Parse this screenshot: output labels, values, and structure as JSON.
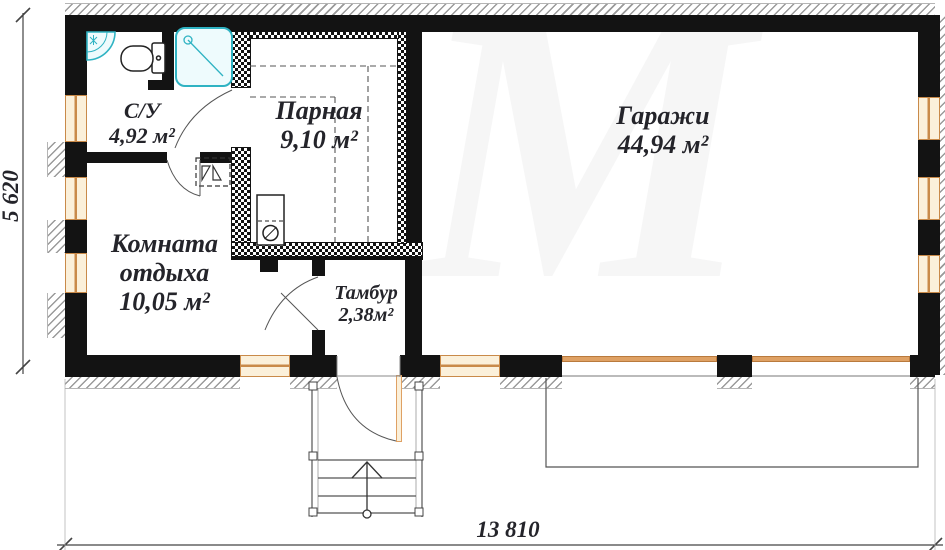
{
  "plan": {
    "title": "Floor plan of sauna with garage",
    "rooms": [
      {
        "id": "su",
        "name": "С/У",
        "area": "4,92 м²"
      },
      {
        "id": "parnaya",
        "name": "Парная",
        "area": "9,10 м²"
      },
      {
        "id": "garazhi",
        "name": "Гаражи",
        "area": "44,94 м²"
      },
      {
        "id": "komnata",
        "name": "Комната",
        "name2": "отдыха",
        "area": "10,05 м²"
      },
      {
        "id": "tambur",
        "name": "Тамбур",
        "area": "2,38м²"
      }
    ],
    "dimensions": {
      "width": "13 810",
      "height": "5 620"
    },
    "watermark": "М",
    "fixtures": [
      "corner-sink",
      "toilet",
      "shower-cabin",
      "sauna-stove",
      "water-heater-unit",
      "entrance-porch-stairs"
    ],
    "colors": {
      "wall": "#131313",
      "window_frame": "#c98a49",
      "window_fill": "#fbf0da",
      "door": "#dfa164",
      "fixture": "#2fb3c3",
      "fixture_fill": "#eefbfd",
      "hatch": "#9a9a9a",
      "text": "#24242a"
    }
  }
}
